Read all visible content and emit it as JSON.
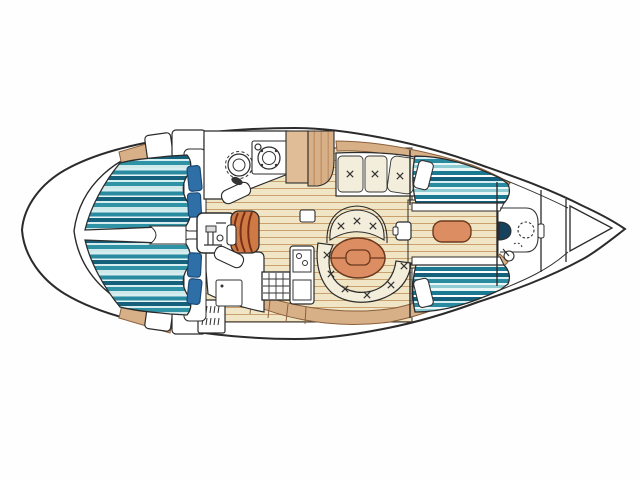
{
  "meta": {
    "description": "Top-view interior layout plan of a sailing yacht, bow pointing right",
    "orientation": "bow-right",
    "text_content": "none (drawing contains no readable text)"
  },
  "colors": {
    "background": "#fefefe",
    "outline": "#2b2b2b",
    "hullFill": "#ffffff",
    "white": "#ffffff",
    "woodBase": "#f0e6c6",
    "woodLine": "#c9a06e",
    "tan": "#d8b088",
    "tanLight": "#e0bd96",
    "tanGrain": "#c2946a",
    "tanEdge": "#8a5f3c",
    "cream": "#f3eedb",
    "tealPale": "#d7eef0",
    "tealSoft": "#cfe8ea",
    "tealMid": "#2a8ba0",
    "tealMid2": "#2f93a5",
    "tealDark": "#15607a",
    "tealDeep": "#1b7a92",
    "tealIce": "#e9f6f6",
    "tealFoam": "#8fccd4",
    "pillowBlue": "#2f6fa8",
    "pillowEdge": "#1a4a74",
    "stepsOrange": "#cf7a45",
    "stepsLine": "#7a3018",
    "tableOrange": "#dd8d62",
    "tableLine": "#6b3a1e",
    "fixtureDark": "#16425e",
    "glyphGray": "#333333",
    "engineGray": "#dddddd"
  },
  "elements": {
    "hull": "yacht-hull-outline",
    "stern": "rounded-transom-arc",
    "aft_cabin_port": "aft-double-berth-top with 2 blue pillows",
    "aft_cabin_starboard": "aft-double-berth-bottom with 2 blue pillows",
    "lockers": "louvered-lockers and white cabinets",
    "head": "toilet and round sink with faucet",
    "wardrobe": "wood wardrobe / nav locker",
    "salon": "settee (3 tufted cushions), fan bench, round dinette, oval wood table",
    "galley": "L-counter, icebox, 4-burner stove grid, double sink, fridge",
    "companionway": "curved steps barrel and engine box",
    "forward_cabin": "two single berths with white pillows, center walkway, seat cushion",
    "forward_head": "shower pan, dark sink, dashed deck hatch, small fixture",
    "bow": "collision bulkheads and anchor-locker triangle"
  }
}
